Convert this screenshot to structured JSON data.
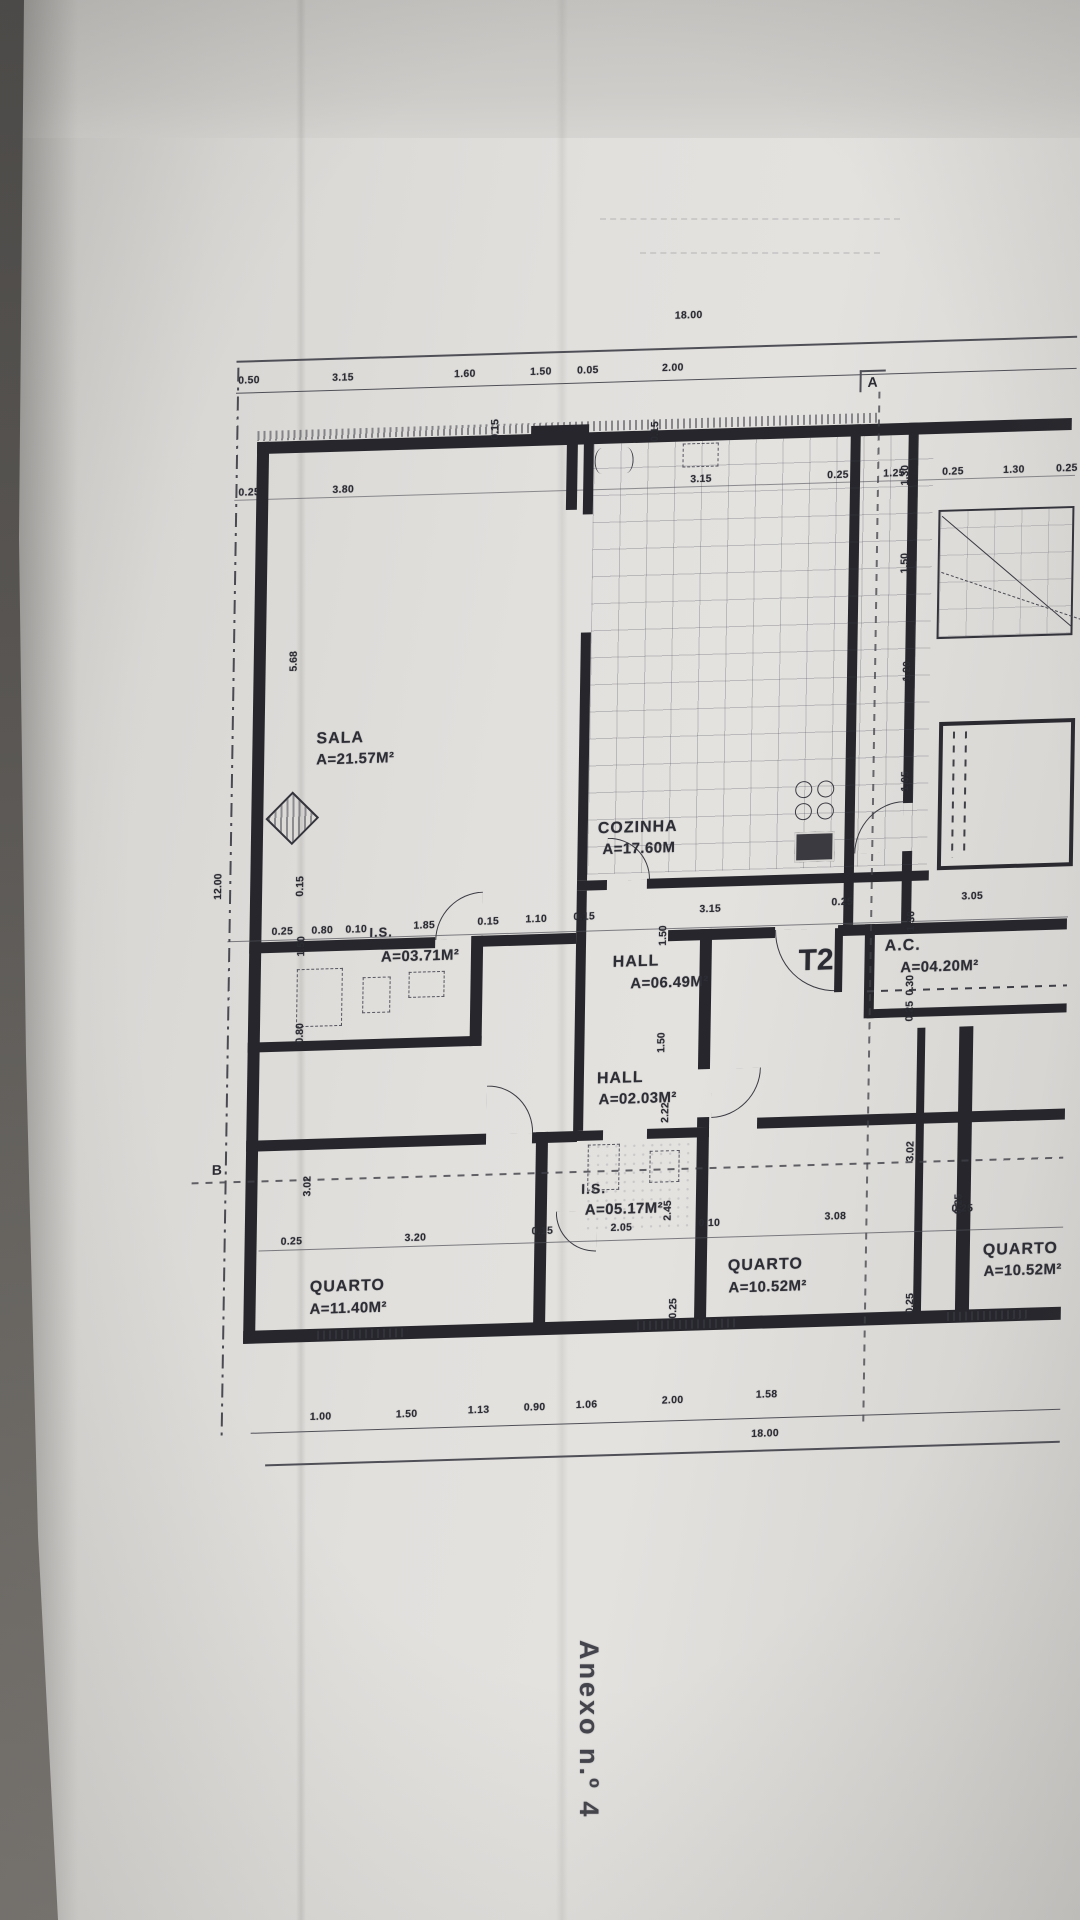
{
  "annex_label": "Anexo n.º 4",
  "sections": {
    "a": "A",
    "b": "B"
  },
  "totals": {
    "top": "18.00",
    "bottom": "18.00",
    "left": "12.00"
  },
  "rooms": {
    "sala": {
      "name": "SALA",
      "area": "A=21.57M²"
    },
    "cozinha": {
      "name": "COZINHA",
      "area": "A=17.60M"
    },
    "is1": {
      "name": "I.S.",
      "area": "A=03.71M²"
    },
    "hall1": {
      "name": "HALL",
      "area": "A=06.49M²"
    },
    "t2": {
      "label": "T2"
    },
    "ac": {
      "name": "A.C.",
      "area": "A=04.20M²"
    },
    "hall2": {
      "name": "HALL",
      "area": "A=02.03M²"
    },
    "is2": {
      "name": "I.S.",
      "area": "A=05.17M²"
    },
    "quarto1": {
      "name": "QUARTO",
      "area": "A=11.40M²"
    },
    "quarto2": {
      "name": "QUARTO",
      "area": "A=10.52M²"
    },
    "quarto3": {
      "name": "QUARTO",
      "area": "A=10.52M²"
    }
  },
  "dims": {
    "top_row": [
      "0.50",
      "3.15",
      "1.60",
      "1.50",
      "0.05",
      "2.00"
    ],
    "wall_row": [
      "0.25",
      "3.80",
      "3.15",
      "0.25",
      "1.25",
      "0.25",
      "1.30",
      "0.25"
    ],
    "mid_row": [
      "0.25",
      "0.80",
      "0.10",
      "1.85",
      "0.15",
      "1.10",
      "0.15",
      "3.15",
      "0.25",
      "3.05"
    ],
    "lower_mid_row": [
      "0.25",
      "3.20",
      "0.15",
      "2.05",
      "0.10",
      "3.08",
      "0.25"
    ],
    "bottom_row": [
      "1.00",
      "1.50",
      "1.13",
      "0.90",
      "1.06",
      "2.00",
      "1.58"
    ],
    "left_col": [
      "5.68",
      "0.15",
      "1.50",
      "0.80",
      "3.02"
    ],
    "center_col": [
      "1.50",
      "1.50",
      "2.22",
      "2.45",
      "0.25"
    ],
    "right_col": [
      "1.30",
      "1.50",
      "1.20",
      "1.05"
    ],
    "right_col2": [
      "1.30",
      "0.30",
      "0.25",
      "3.02",
      "0.25",
      "0.25"
    ],
    "top_vertical": [
      "0.15",
      "0.15"
    ]
  }
}
